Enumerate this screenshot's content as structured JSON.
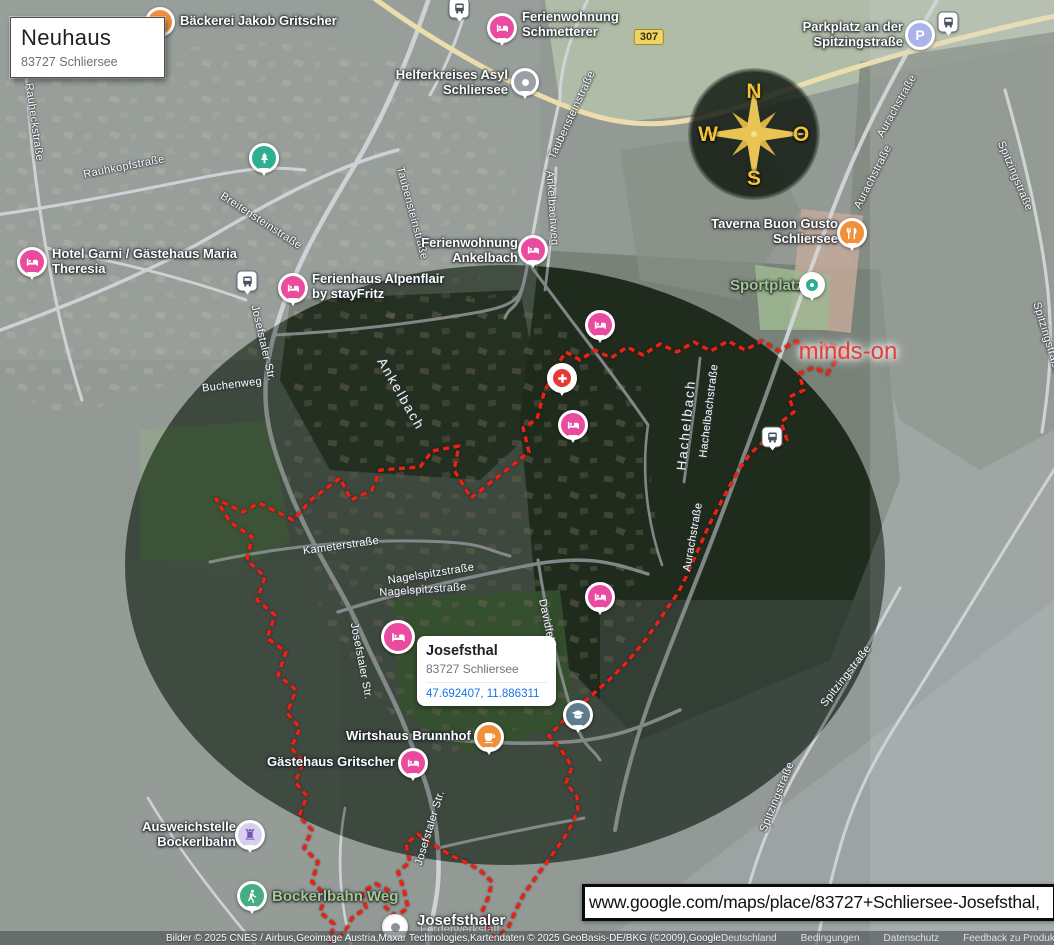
{
  "title_card": {
    "title": "Neuhaus",
    "subtitle": "83727 Schliersee"
  },
  "place_card": {
    "title": "Josefsthal",
    "subtitle": "83727 Schliersee",
    "coordinates": "47.692407, 11.886311"
  },
  "url_bar": {
    "url": "www.google.com/maps/place/83727+Schliersee-Josefsthal,"
  },
  "watermark": "minds-on",
  "road_shield": "307",
  "compass": {
    "n": "N",
    "e": "O",
    "s": "S",
    "w": "W"
  },
  "icons": {
    "parking_glyph": "P",
    "landmark_glyph": "♜"
  },
  "pois": {
    "bakery": "Bäckerei Jakob Gritscher",
    "schmetterer": "Ferienwohnung Schmetterer",
    "helferkreis": "Helferkreises Asyl Schliersee",
    "parkplatz": "Parkplatz an der Spitzingstraße",
    "hotel_garni": "Hotel Garni / Gästehaus Maria Theresia",
    "alpenflair": "Ferienhaus Alpenflair by stayFritz",
    "fewo_ankelbach": "Ferienwohnung Ankelbach",
    "taverna": "Taverna Buon Gusto Schliersee",
    "sportplatz": "Sportplatz",
    "wirtshaus": "Wirtshaus Brunnhof",
    "gritscher": "Gästehaus Gritscher",
    "ausweichstelle": "Ausweichstelle Bockerlbahn",
    "bockerlbahn_weg": "Bockerlbahn Weg",
    "josefsthaler": "Josefsthaler",
    "josefsthaler_line2": "Förderwerkstatt"
  },
  "streets": {
    "rauheck": "Rauheckstraße",
    "rauhkopf": "Rauhkopfstraße",
    "breitenstein": "Breitensteinstraße",
    "taubenstein": "Taubensteinstraße",
    "ankelbachweg": "Ankelbachweg",
    "josefstaler": "Josefstaler Str.",
    "buchenweg": "Buchenweg",
    "ankelbach": "Ankelbach",
    "kameter": "Kameterstraße",
    "nagelspitz": "Nagelspitzstraße",
    "davidfeld": "Davidfeld",
    "hachelbach": "Hachelbach",
    "hachelbachstr": "Hachelbachstraße",
    "aurach": "Aurachstraße",
    "spitzing": "Spitzingstraße"
  },
  "colors": {
    "marker_pink": "#ea4b9f",
    "marker_orange": "#f0903a",
    "marker_teal": "#2fae92",
    "marker_lavender": "#aab4e8",
    "marker_gray": "#9aa0a6",
    "boundary_red": "#ea2114",
    "compass_gold": "#e9c455",
    "link_blue": "#1a73e8",
    "label_green": "#a3c78e",
    "watermark_red": "#e2403a",
    "shield_yellow": "#f2d465"
  },
  "attribution": {
    "imagery": "Bilder © 2025 CNES / Airbus,Geoimage Austria,Maxar Technologies,Kartendaten © 2025 GeoBasis-DE/BKG (©2009),Google",
    "links": [
      "Deutschland",
      "Bedingungen",
      "Datenschutz",
      "Feedback zu Produkt(en)"
    ]
  }
}
